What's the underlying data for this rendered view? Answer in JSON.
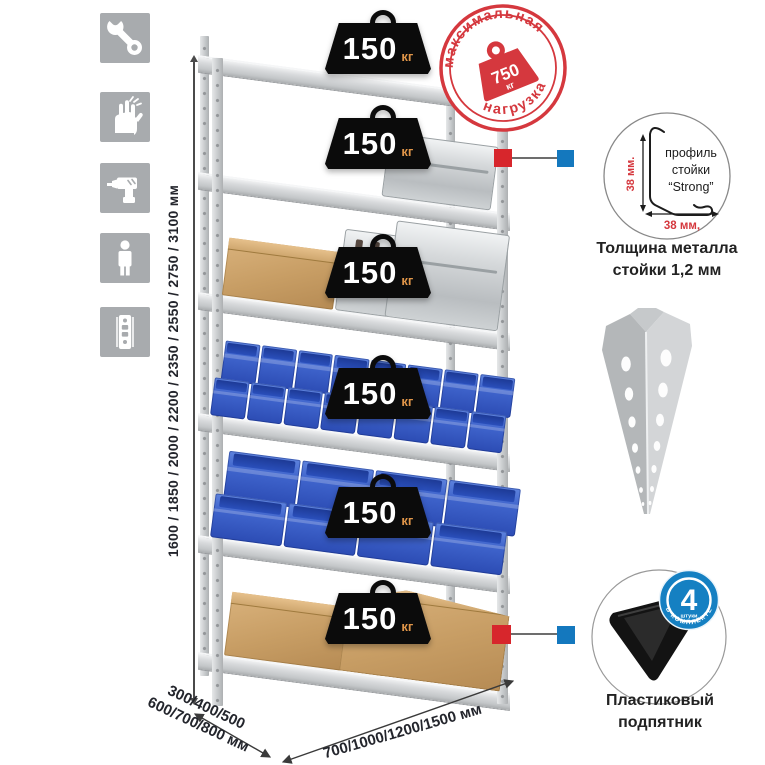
{
  "sidebar": {
    "icons": [
      {
        "name": "wrench-icon"
      },
      {
        "name": "gloves-icon"
      },
      {
        "name": "drill-icon"
      },
      {
        "name": "person-icon"
      },
      {
        "name": "rack-post-icon"
      }
    ]
  },
  "rack": {
    "shelf_load_badges": [
      {
        "value": "150",
        "unit": "кг"
      },
      {
        "value": "150",
        "unit": "кг"
      },
      {
        "value": "150",
        "unit": "кг"
      },
      {
        "value": "150",
        "unit": "кг"
      },
      {
        "value": "150",
        "unit": "кг"
      },
      {
        "value": "150",
        "unit": "кг"
      }
    ]
  },
  "max_load_stamp": {
    "arc_top": "максимальная",
    "arc_bottom": "нагрузка",
    "value": "750",
    "unit": "кг"
  },
  "dimensions": {
    "heights": "1600 / 1850 / 2000 / 2200 / 2350 / 2550 / 2750 / 3100 мм",
    "depths_line1": "300/400/500",
    "depths_line2": "600/700/800 мм",
    "widths": "700/1000/1200/1500 мм"
  },
  "profile_detail": {
    "label_line1": "профиль",
    "label_line2": "стойки",
    "label_line3": "“Strong”",
    "dim_vertical": "38 мм.",
    "dim_horizontal": "38 мм,",
    "caption_line1": "Толщина металла",
    "caption_line2": "стойки 1,2 мм"
  },
  "foot_detail": {
    "badge_value": "4",
    "badge_word": "штуки",
    "badge_arc": "в комплекте",
    "caption_line1": "Пластиковый",
    "caption_line2": "подпятник"
  },
  "colors": {
    "accent_red": "#d5383e",
    "accent_blue": "#1478be",
    "bin_blue": "#3f64cc",
    "badge_blue": "#1580c2"
  }
}
